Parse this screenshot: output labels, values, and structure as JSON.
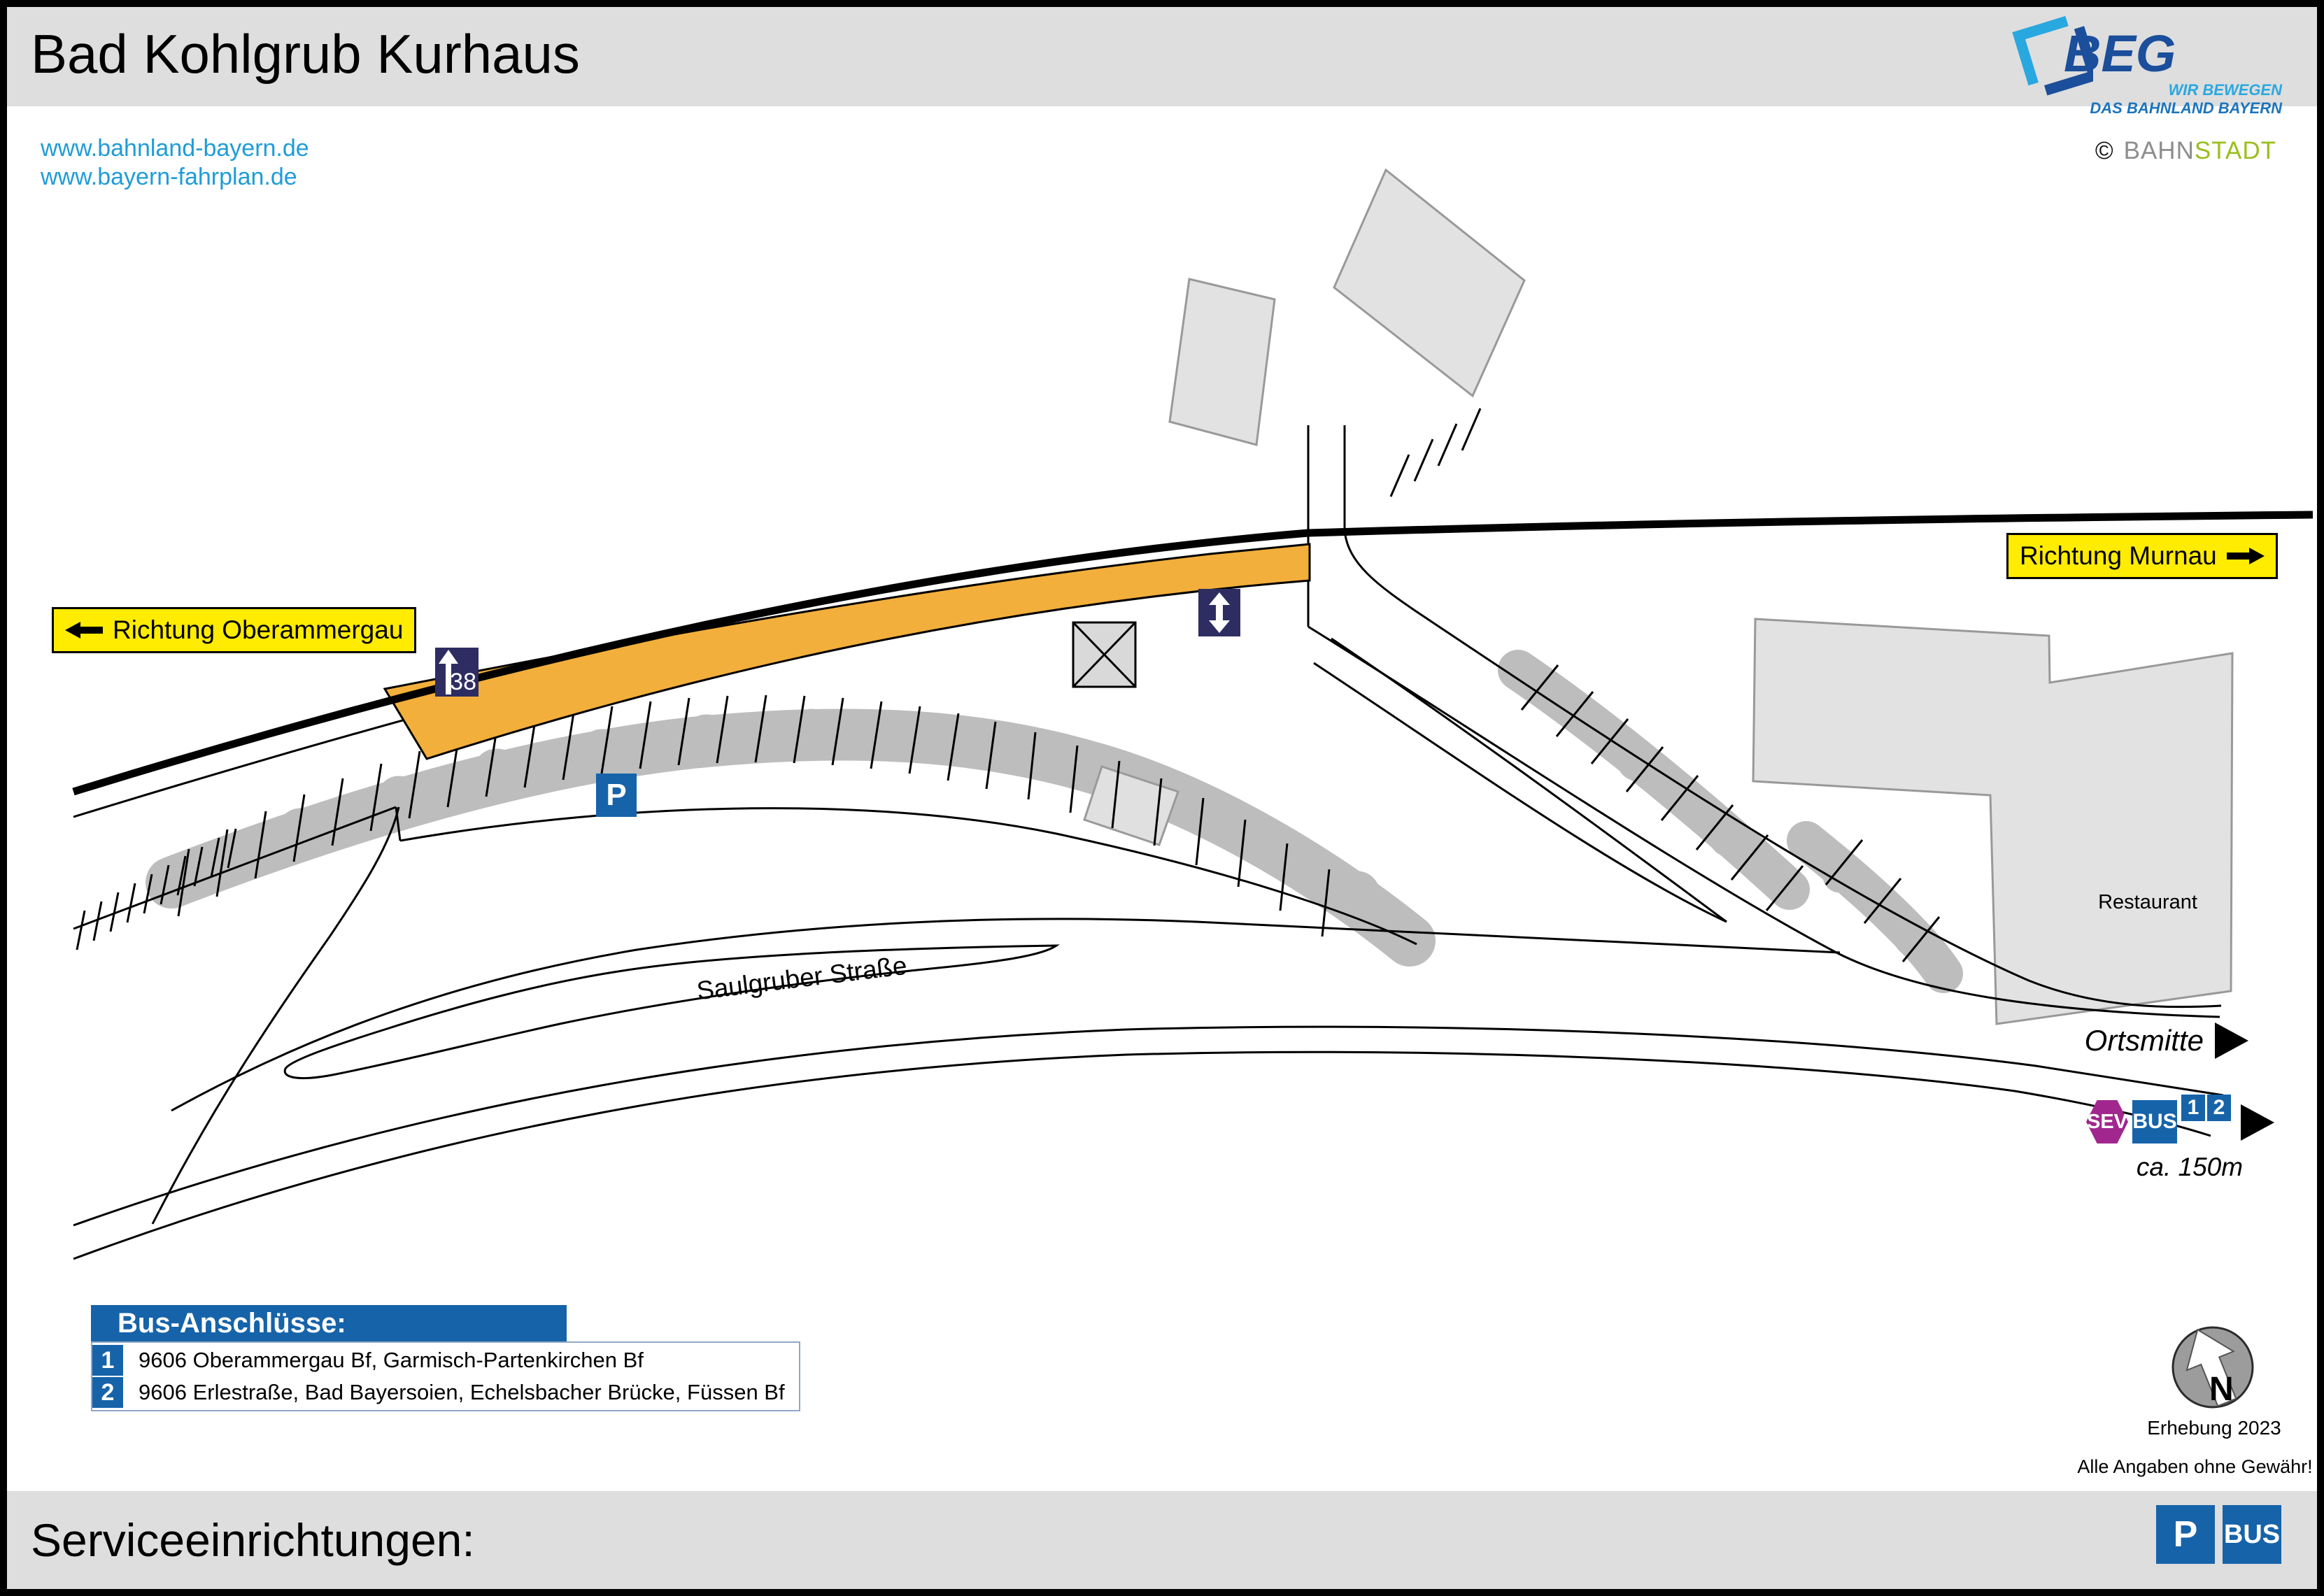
{
  "header": {
    "title": "Bad Kohlgrub Kurhaus"
  },
  "links": {
    "line1": "www.bahnland-bayern.de",
    "line2": "www.bayern-fahrplan.de"
  },
  "branding": {
    "beg": "BEG",
    "tagline1": "WIR BEWEGEN",
    "tagline2": "DAS BAHNLAND BAYERN",
    "copyright": "©",
    "bahn": "BAHN",
    "stadt": "STADT"
  },
  "map": {
    "direction_left": "Richtung Oberammergau",
    "direction_right": "Richtung Murnau",
    "platform_height": "38",
    "parking": "P",
    "street": "Saulgruber Straße",
    "restaurant": "Restaurant",
    "ortsmitte": "Ortsmitte",
    "sev": "SEV",
    "bus": "BUS",
    "bus_line1": "1",
    "bus_line2": "2",
    "distance": "ca. 150m",
    "north": "N"
  },
  "legend": {
    "title": "Bus-Anschlüsse:",
    "rows": [
      {
        "num": "1",
        "text": "9606 Oberammergau Bf, Garmisch-Partenkirchen Bf"
      },
      {
        "num": "2",
        "text": "9606 Erlestraße, Bad Bayersoien, Echelsbacher Brücke, Füssen Bf"
      }
    ]
  },
  "meta": {
    "survey": "Erhebung 2023",
    "disclaimer": "Alle Angaben ohne Gewähr!"
  },
  "footer": {
    "label": "Serviceeinrichtungen:",
    "p": "P",
    "bus": "BUS"
  },
  "colors": {
    "accent_yellow": "#FFEC00",
    "navy": "#2D2D62",
    "service_blue": "#1663A9",
    "sev_magenta": "#A1278E",
    "platform_orange": "#F3AF3B",
    "link_blue": "#1E9CD8",
    "bar_gray": "#DEDEDE",
    "tree_gray": "#BDBDBD"
  }
}
